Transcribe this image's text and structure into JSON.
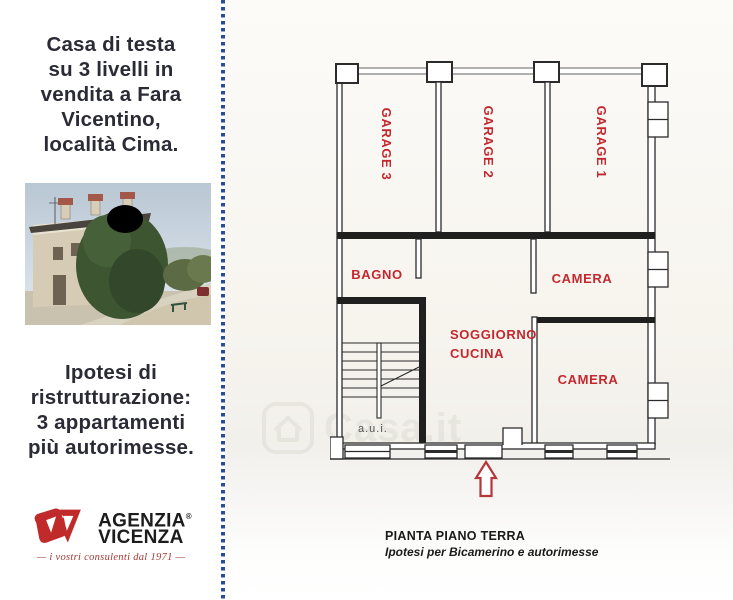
{
  "left_panel": {
    "headline": {
      "line1": "Casa di testa",
      "line2": "su 3 livelli in",
      "line3": "vendita a Fara",
      "line4": "Vicentino,",
      "line5": "località Cima."
    },
    "hypothesis": {
      "line1": "Ipotesi di",
      "line2": "ristrutturazione:",
      "line3": "3 appartamenti",
      "line4": "più autorimesse."
    },
    "logo": {
      "name_top": "AGENZIA",
      "name_bottom": "VICENZA",
      "registered": "®",
      "tagline": "— i vostri consulenti dal 1971 —"
    }
  },
  "floor_plan": {
    "labels": {
      "garage3": "GARAGE 3",
      "garage2": "GARAGE 2",
      "garage1": "GARAGE 1",
      "bagno": "BAGNO",
      "camera_top": "CAMERA",
      "soggiorno_line1": "SOGGIORNO",
      "soggiorno_line2": "CUCINA",
      "camera_bottom": "CAMERA",
      "aui": "a.u.i."
    },
    "caption": {
      "title": "PIANTA PIANO TERRA",
      "subtitle": "Ipotesi per Bicamerino e autorimesse"
    }
  },
  "watermark": {
    "text": "Casa.it"
  },
  "colors": {
    "label_red": "#c4282e",
    "brand_red": "#c02a2a",
    "divider_blue": "#2a4a9e",
    "headline_text": "#2b2b36",
    "tagline_red": "#a13a36",
    "arrow_red": "#b5373c",
    "dark_wall": "#1f1f1f"
  }
}
